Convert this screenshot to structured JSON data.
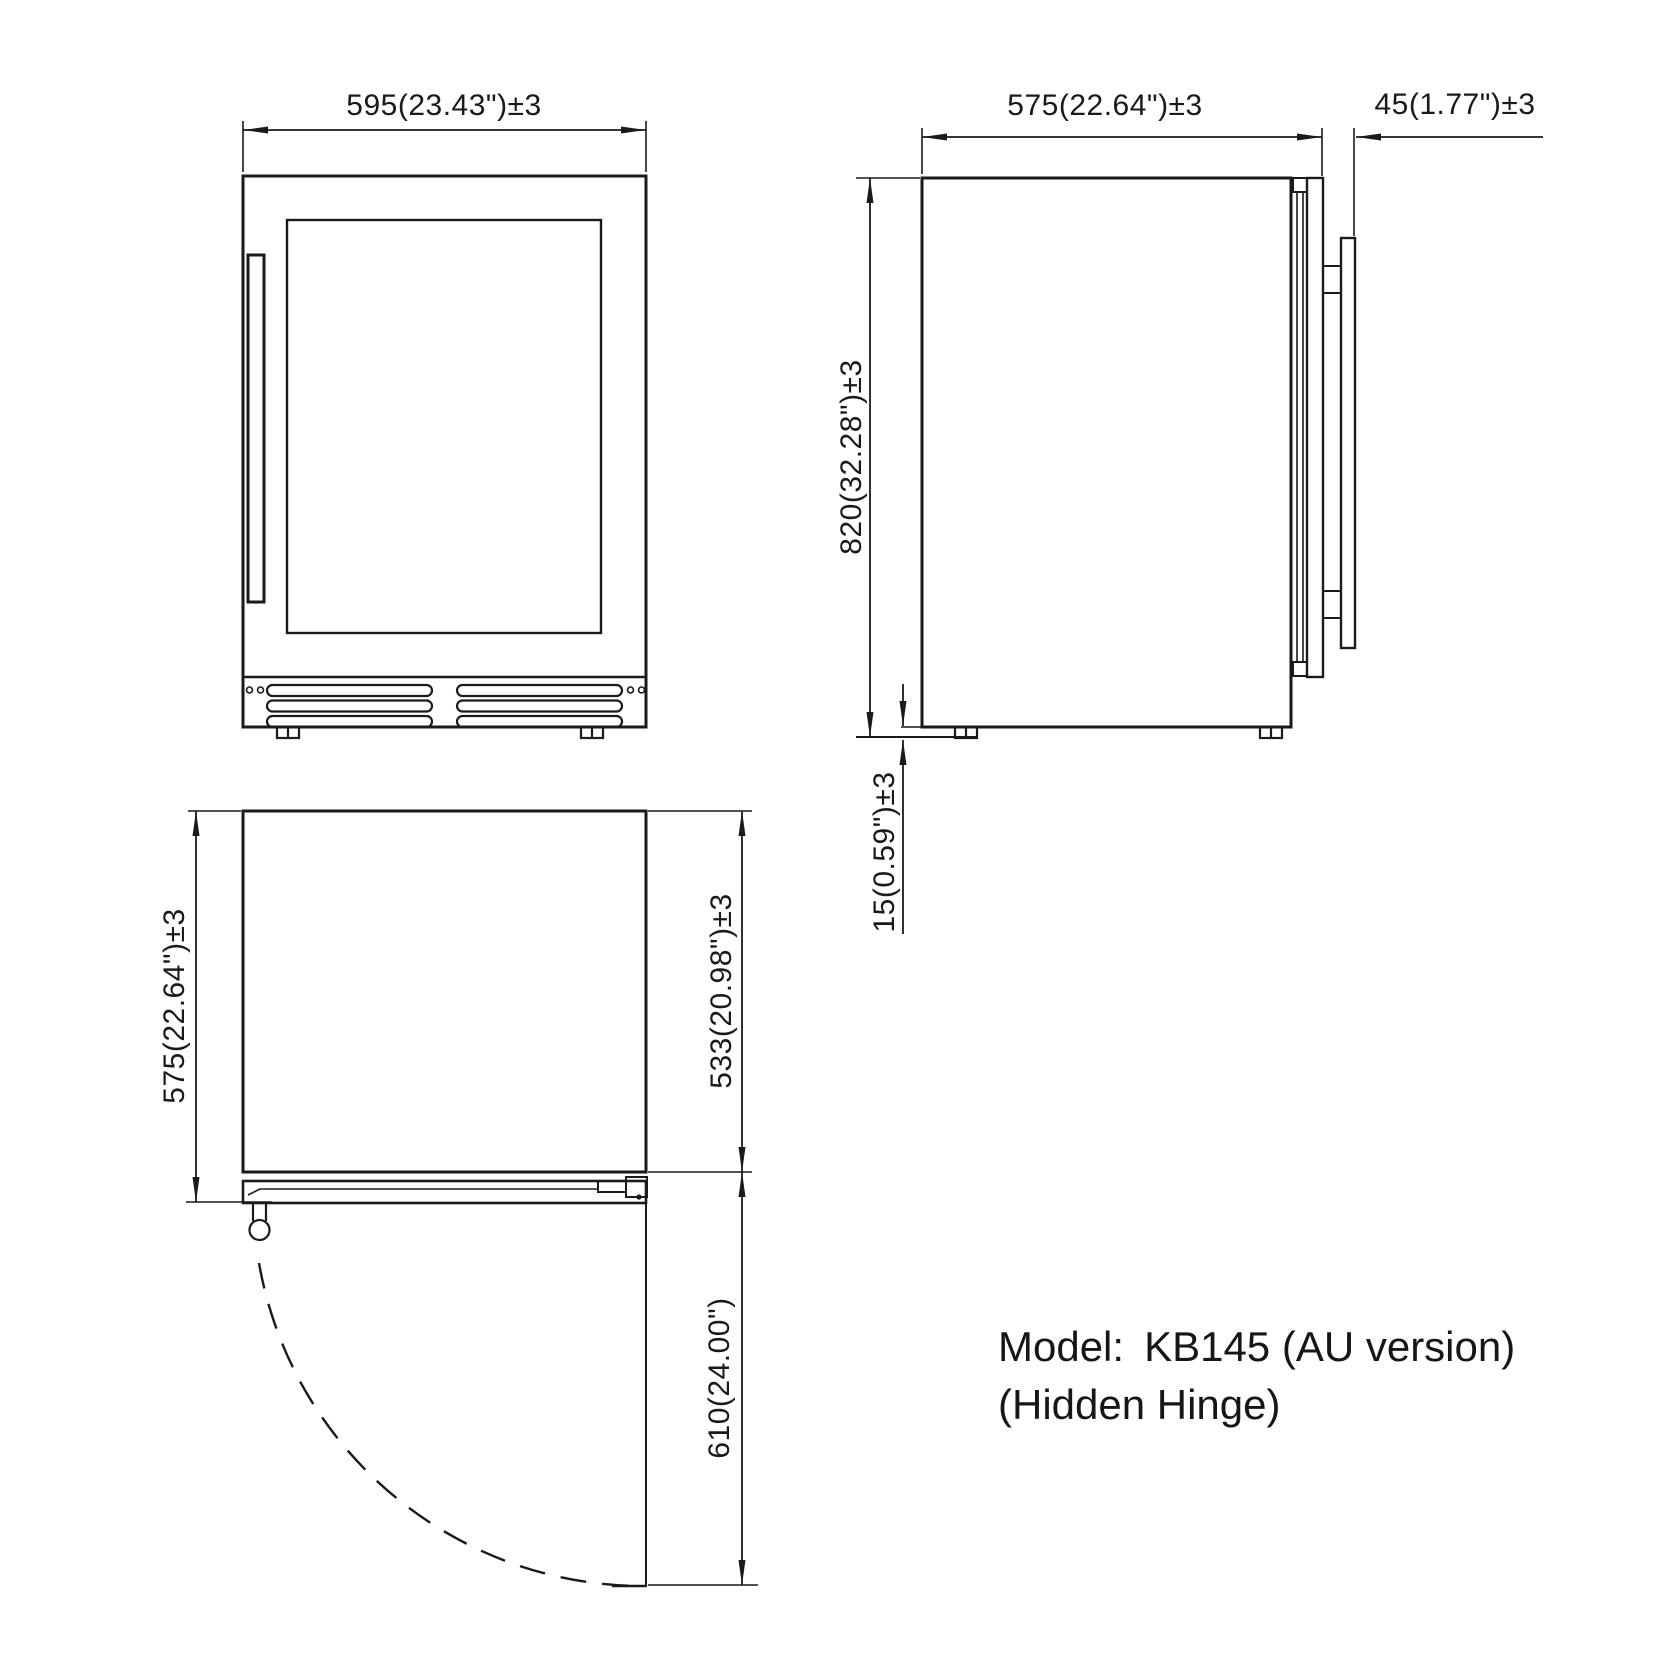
{
  "colors": {
    "line": "#1a1a1a",
    "background": "#ffffff"
  },
  "front_view": {
    "width_dim": "595(23.43\")±3"
  },
  "side_view": {
    "depth_dim": "575(22.64\")±3",
    "door_thickness_dim": "45(1.77\")±3",
    "height_dim": "820(32.28\")±3",
    "leg_height_dim": "15(0.59\")±3"
  },
  "top_view": {
    "depth_dim": "575(22.64\")±3",
    "cabinet_depth_dim": "533(20.98\")±3",
    "door_swing_dim": "610(24.00\")"
  },
  "model": {
    "label": "Model:",
    "value": "KB145 (AU version)",
    "note": "(Hidden Hinge)"
  }
}
